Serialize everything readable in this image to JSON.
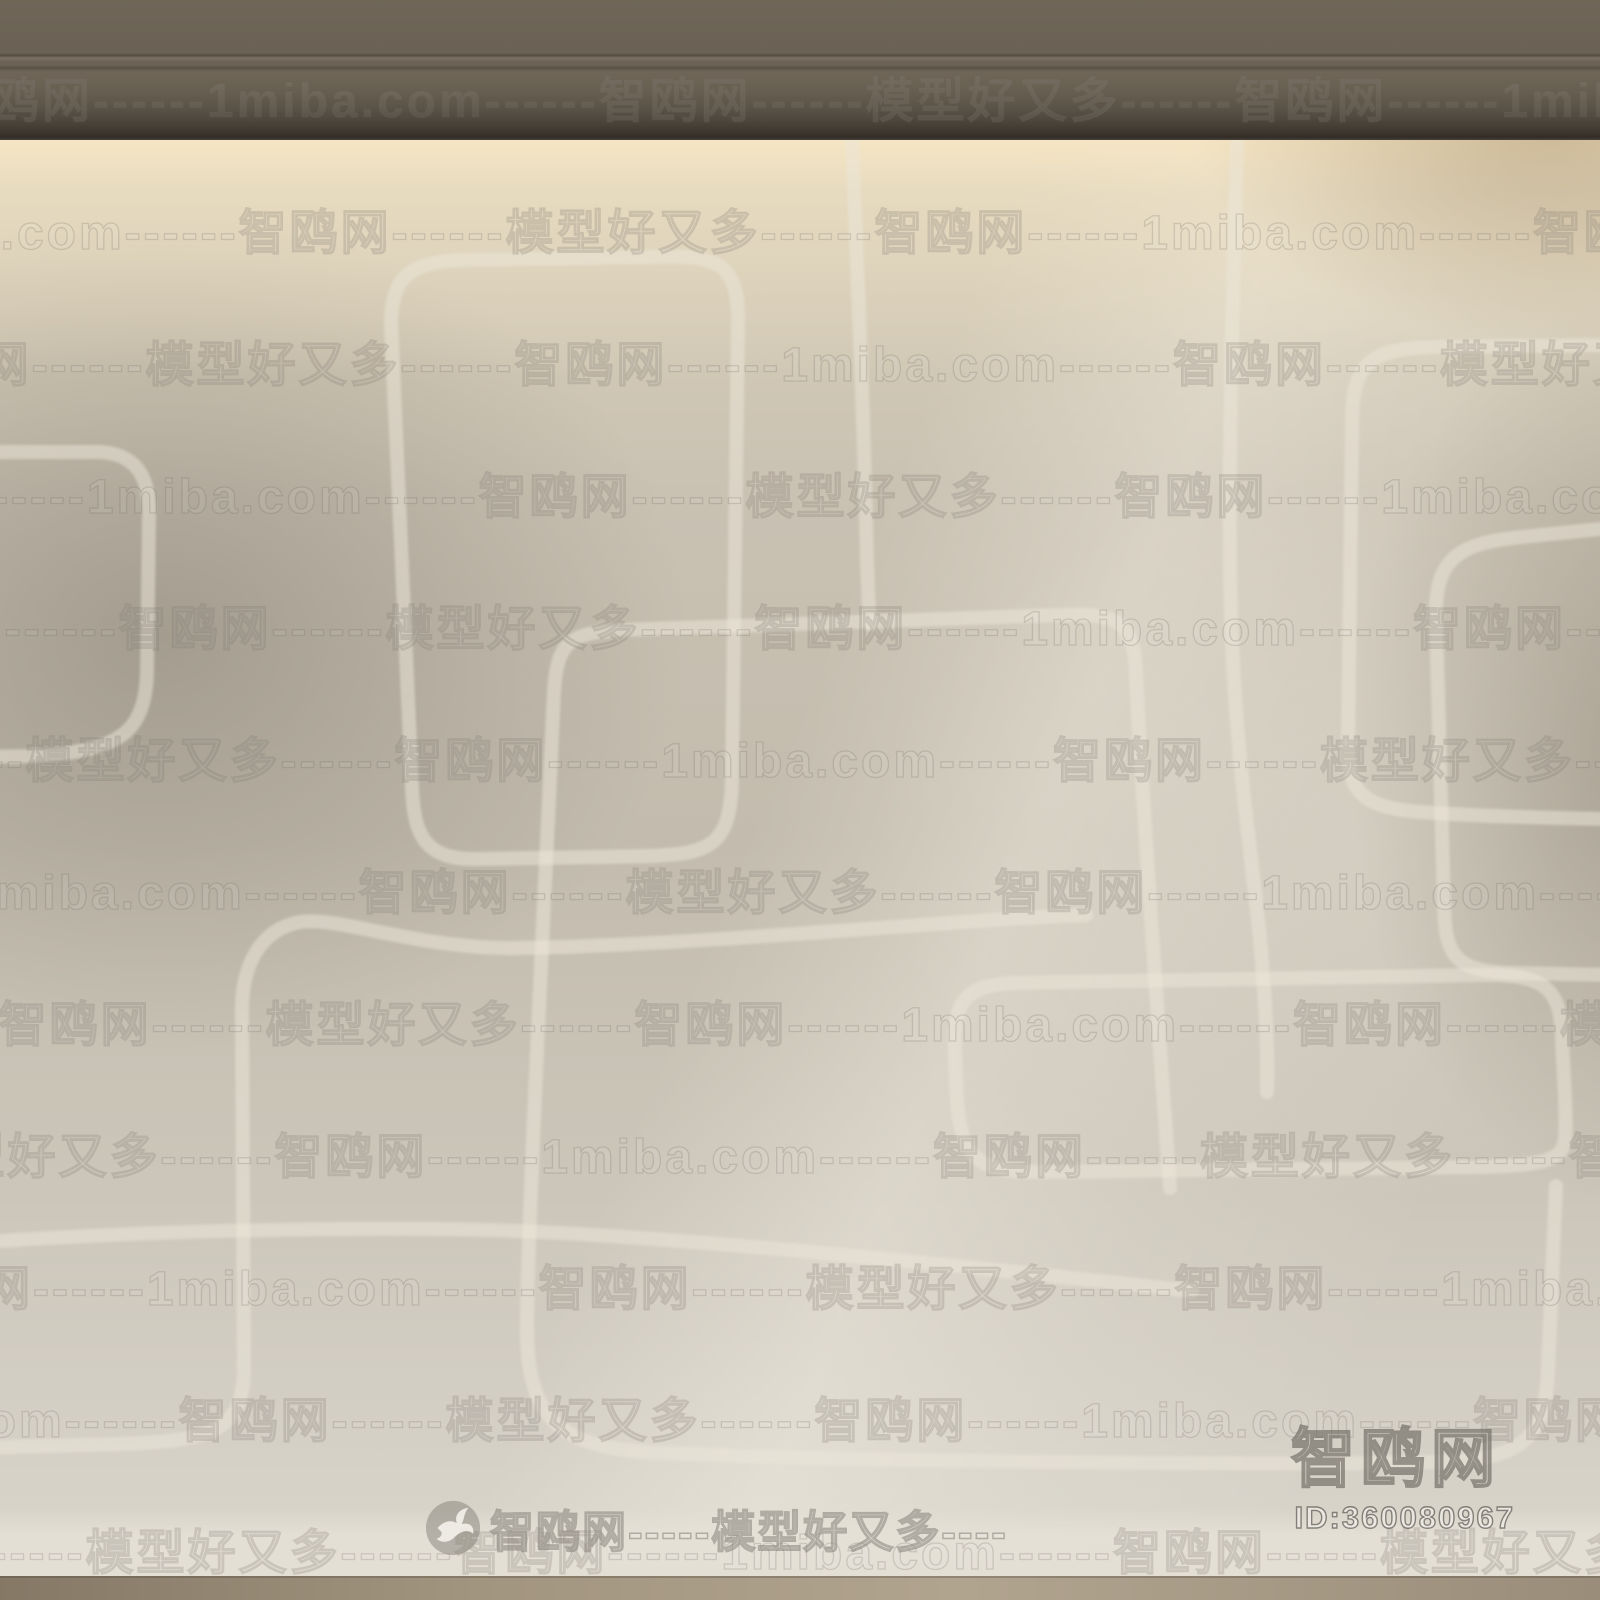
{
  "watermarks": {
    "site_name": "智鸥网",
    "site_domain": "1miba.com",
    "tagline": "模型好又多",
    "tile_text": "智鸥网------1miba.com------智鸥网------模型好又多------",
    "tile_rows": [
      {
        "y": 95,
        "offset": -60
      },
      {
        "y": 227,
        "offset": -420
      },
      {
        "y": 359,
        "offset": -780
      },
      {
        "y": 491,
        "offset": -180
      },
      {
        "y": 623,
        "offset": -540
      },
      {
        "y": 755,
        "offset": -900
      },
      {
        "y": 887,
        "offset": -300
      },
      {
        "y": 1019,
        "offset": -660
      },
      {
        "y": 1151,
        "offset": -1020
      },
      {
        "y": 1283,
        "offset": -120
      },
      {
        "y": 1415,
        "offset": -480
      },
      {
        "y": 1547,
        "offset": -840
      }
    ],
    "footer": {
      "text": "智鸥网-----模型好又多----"
    },
    "corner": {
      "brand": "智鸥网",
      "id": "ID:360080967"
    }
  },
  "colors": {
    "molding": "#6c6356",
    "wall_light": "#ddd3bc",
    "wall_mid": "#c6bfb1",
    "wall_bright": "#d9d5cb",
    "pattern_line": "#ece6d8",
    "baseboard": "#e3dfd5",
    "floor": "#a2957f",
    "watermark_ink": "#6e6a60"
  }
}
